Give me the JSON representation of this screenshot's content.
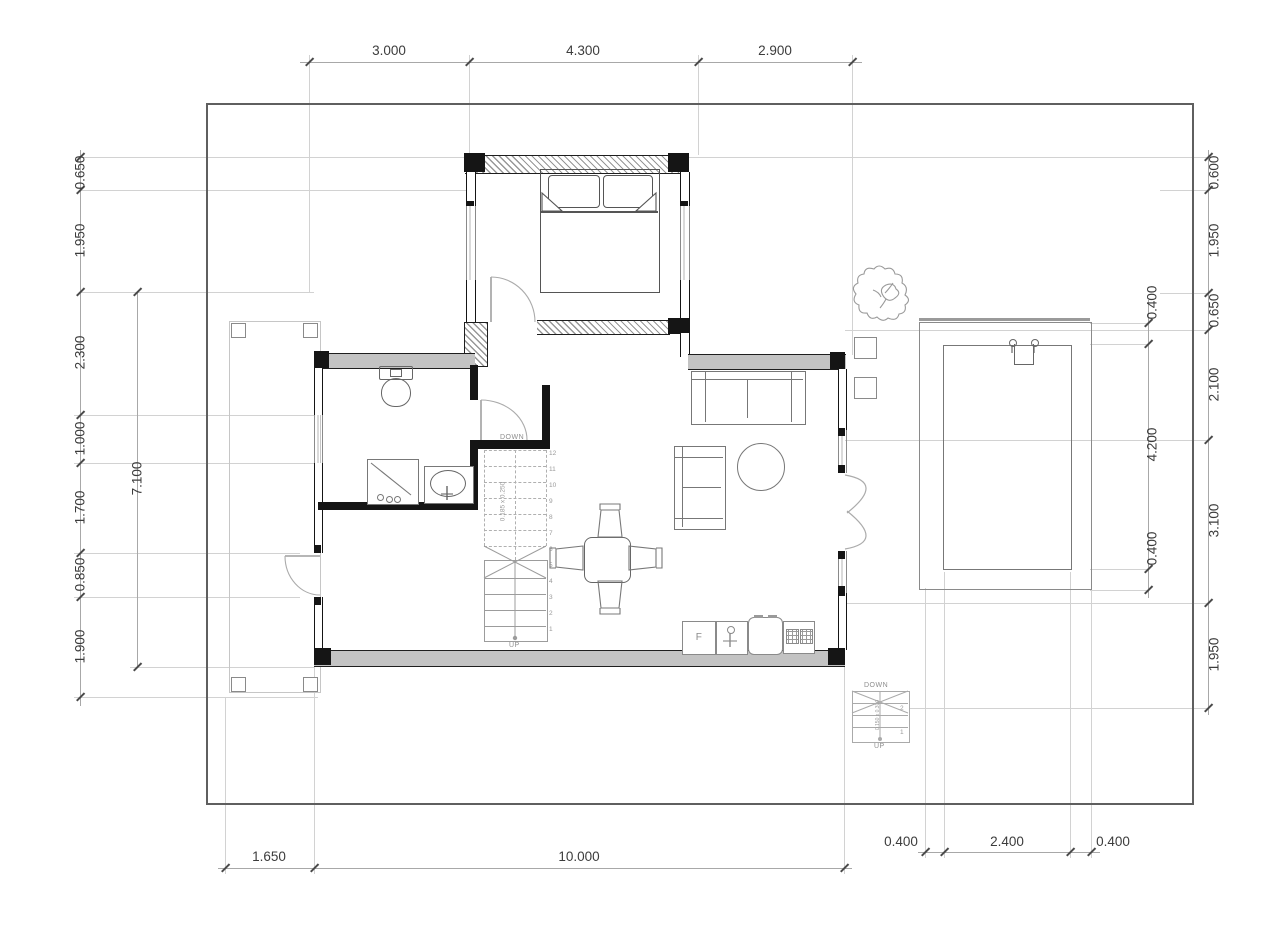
{
  "drawing_type": "floor-plan",
  "dims": {
    "top": [
      "3.000",
      "4.300",
      "2.900"
    ],
    "bottom": [
      "1.650",
      "10.000"
    ],
    "bottom_right": [
      "0.400",
      "2.400",
      "0.400"
    ],
    "left": [
      "0.650",
      "1.950",
      "2.300",
      "1.000",
      "1.700",
      "0.850",
      "1.900"
    ],
    "left_inner": "7.100",
    "right": [
      "0.600",
      "1.950",
      "0.650",
      "2.100",
      "3.100",
      "1.950"
    ],
    "right_inner": [
      "0.400",
      "4.200",
      "0.400"
    ]
  },
  "stairs": {
    "down_label": "DOWN",
    "up_label": "UP",
    "note": "0.185 x 0.250",
    "tread_numbers": [
      "12",
      "11",
      "10",
      "9",
      "8",
      "7",
      "6",
      "5",
      "4",
      "3",
      "2",
      "1"
    ]
  },
  "exterior_stairs": {
    "down_label": "DOWN",
    "up_label": "UP",
    "note": "0.150 x 0.300",
    "tread_numbers": [
      "2",
      "1"
    ]
  },
  "kitchen": {
    "fridge_label": "F"
  },
  "colors": {
    "wall": "#151515",
    "gray_wall": "#c3c3c3",
    "dim_text": "#3c3c3c",
    "grid_line": "#d2d2d2",
    "furniture_line": "#787878"
  }
}
